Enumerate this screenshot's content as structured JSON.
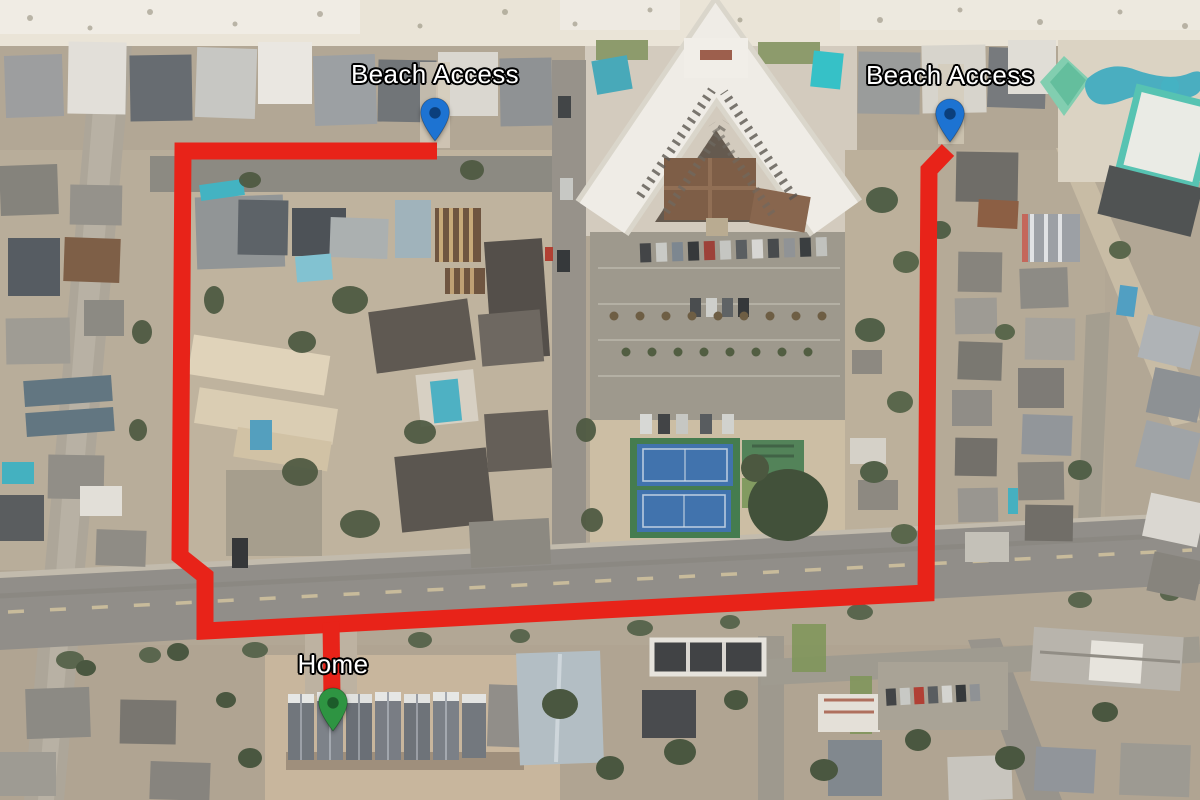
{
  "map": {
    "route": {
      "color": "#e82319",
      "stroke_width": 17,
      "main_points": "437,151 183,151 180,556 205,576 205,631 926,593 929,170 948,150",
      "home_branch_points": "331,622 332,697"
    },
    "markers": [
      {
        "id": "beach-access-west",
        "label": "Beach Access",
        "pin_color": "#1d73d2",
        "pin_hole_color": "#0b3f7c",
        "x": 435,
        "y": 142
      },
      {
        "id": "beach-access-east",
        "label": "Beach Access",
        "pin_color": "#1d73d2",
        "pin_hole_color": "#0b3f7c",
        "x": 950,
        "y": 143
      },
      {
        "id": "home",
        "label": "Home",
        "pin_color": "#2e9442",
        "pin_hole_color": "#1c5b2a",
        "x": 333,
        "y": 732
      }
    ]
  }
}
